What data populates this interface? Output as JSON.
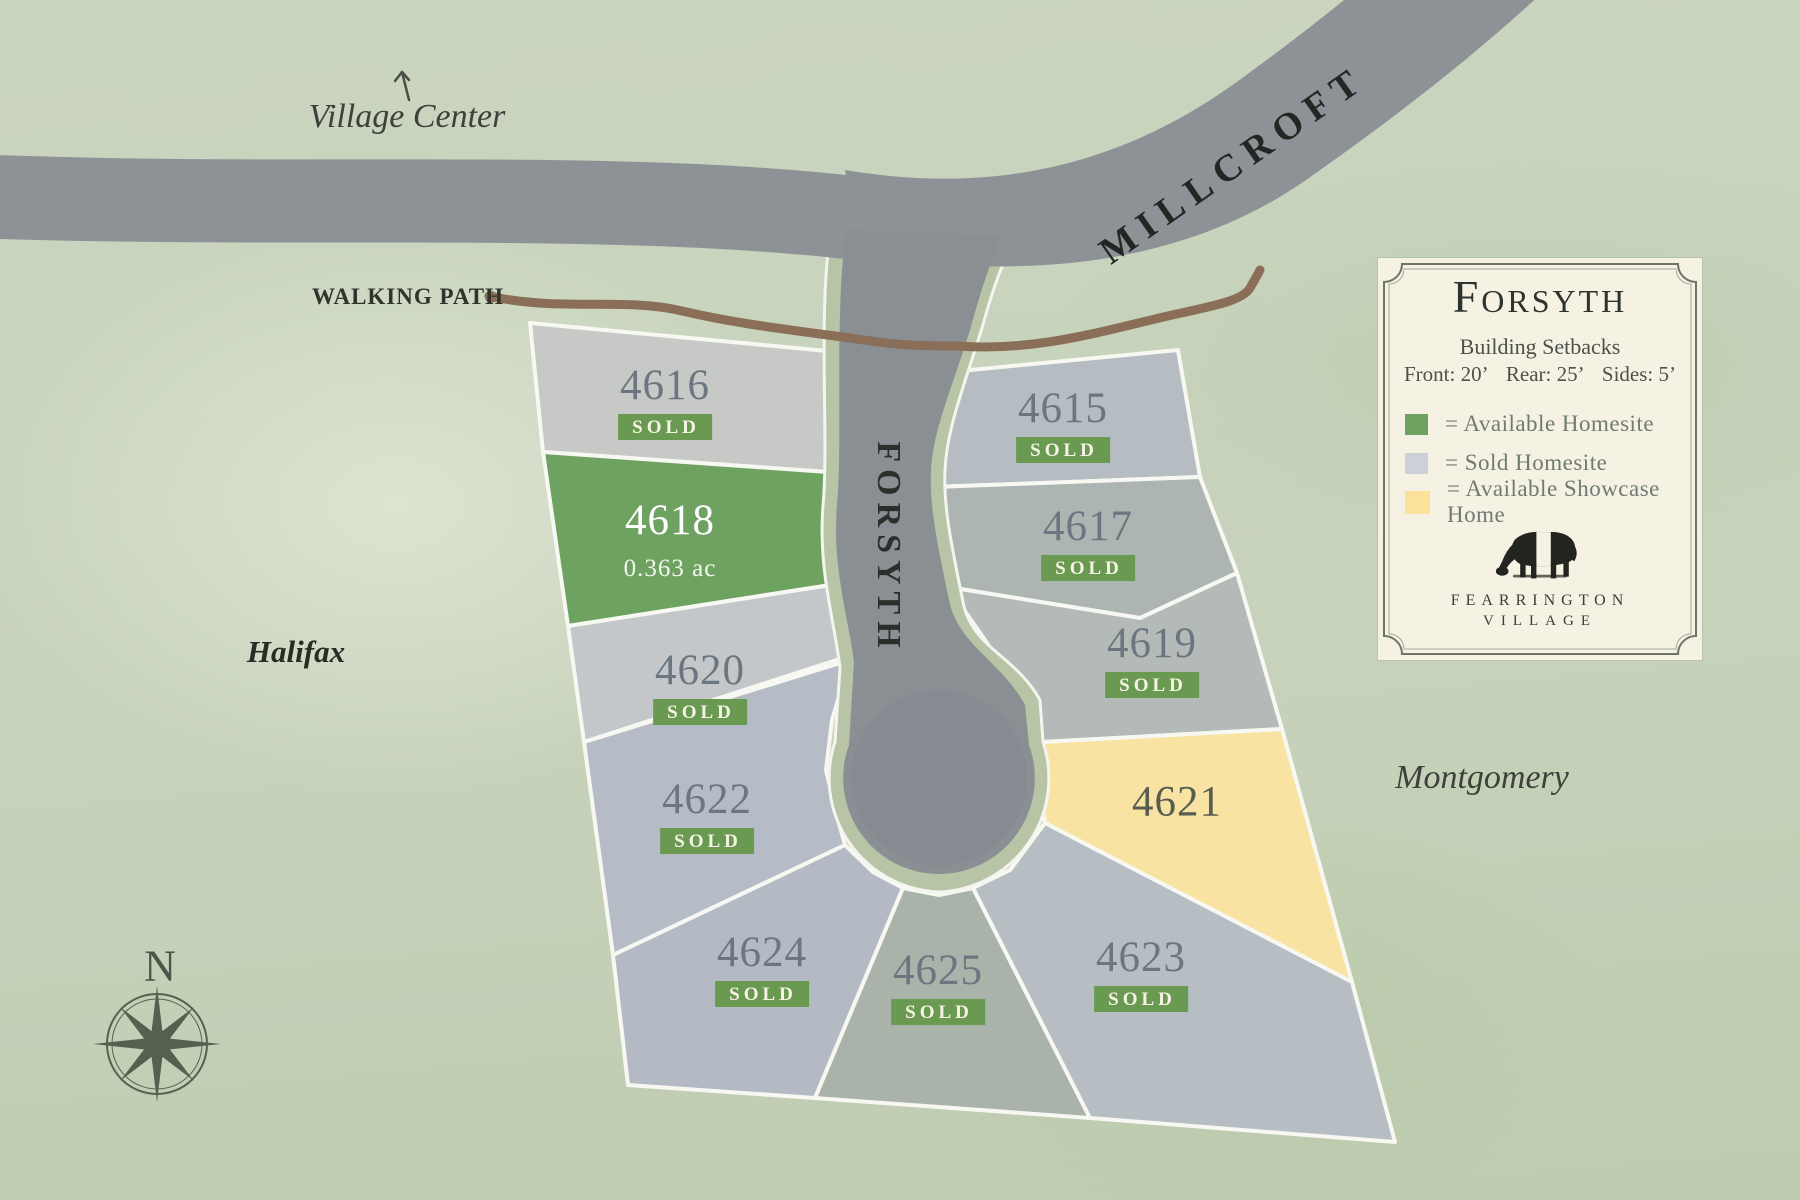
{
  "map": {
    "background_labels": {
      "village_center": "Village Center",
      "walking_path": "WALKING PATH",
      "halifax": "Halifax",
      "montgomery": "Montgomery",
      "compass_north": "N"
    },
    "streets": {
      "millcroft": "MILLCROFT",
      "forsyth": "FORSYTH"
    },
    "lots": [
      {
        "number": "4616",
        "status": "SOLD",
        "fill": "#c6c9c5"
      },
      {
        "number": "4618",
        "area": "0.363 ac",
        "fill": "#6ea261"
      },
      {
        "number": "4620",
        "status": "SOLD",
        "fill": "#c3c7c9"
      },
      {
        "number": "4622",
        "status": "SOLD",
        "fill": "#b6bcc6"
      },
      {
        "number": "4624",
        "status": "SOLD",
        "fill": "#b4bac4"
      },
      {
        "number": "4625",
        "status": "SOLD",
        "fill": "#a9b3aa"
      },
      {
        "number": "4615",
        "status": "SOLD",
        "fill": "#b5bcc2"
      },
      {
        "number": "4617",
        "status": "SOLD",
        "fill": "#adb5b2"
      },
      {
        "number": "4619",
        "status": "SOLD",
        "fill": "#b3bab8"
      },
      {
        "number": "4621",
        "fill": "#f9e3a2"
      },
      {
        "number": "4623",
        "status": "SOLD",
        "fill": "#b6bec4"
      }
    ]
  },
  "legend": {
    "title": "Forsyth",
    "setbacks_heading": "Building Setbacks",
    "setbacks": {
      "front": "Front: 20’",
      "rear": "Rear: 25’",
      "sides": "Sides: 5’"
    },
    "items": [
      {
        "color": "#6ea261",
        "label": "=  Available Homesite"
      },
      {
        "color": "#ccd0d7",
        "label": "=  Sold Homesite"
      },
      {
        "color": "#fbe29b",
        "label": "=  Available Showcase Home"
      }
    ],
    "brand": {
      "line1": "Fearrington",
      "line2": "Village"
    }
  },
  "colors": {
    "background": "#c7d2bb",
    "road": "#8d9297",
    "verge": "#b7c5a6",
    "lot_boundary": "#f8f8f3",
    "sold_badge_green": "#6a9a52",
    "walking_path_brown": "#8a6e58"
  }
}
